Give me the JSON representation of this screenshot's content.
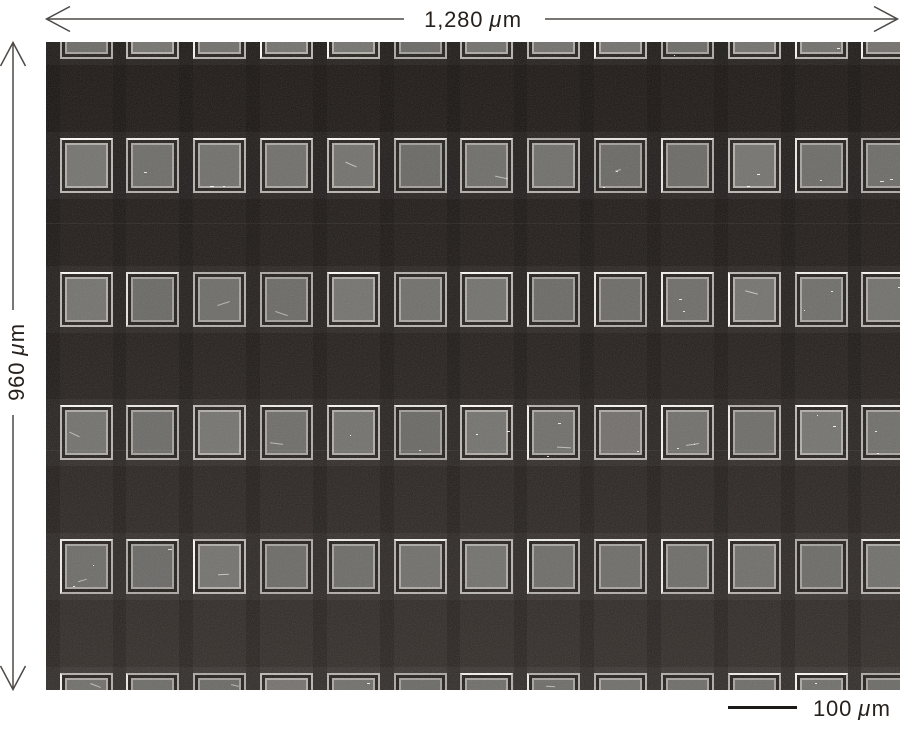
{
  "annotations": {
    "top": {
      "value": "1,280"
    },
    "left": {
      "value": "960"
    },
    "scalebar": {
      "value": "100"
    },
    "unit_mu": "μ",
    "unit_m": "m"
  },
  "annotation_style": {
    "line_color": "#4d4946",
    "text_color": "#27211d",
    "scalebar_color": "#1c1a18"
  },
  "micrograph": {
    "grid": {
      "cols": 13,
      "rows": 6,
      "origin_x": 13.5,
      "origin_y": -38,
      "pitch_x": 66.83,
      "pitch_y": 133.8,
      "square_w": 53,
      "square_h": 55,
      "gap_stripe_w": 13.8
    },
    "colors": {
      "bg_top": "#1a1512",
      "bg_mid": "#221d1a",
      "bg_bottom": "#332d29",
      "fill": "#6e6c68",
      "ring_outer": "#b2afab",
      "ring_inner": "#a9a6a2",
      "ring_gap": "#241f1b",
      "ring_highlight": "#f2f0ec",
      "row_band": "rgba(255,255,255,0.045)",
      "col_stripe": "rgba(0,0,0,0.18)"
    },
    "effects": {
      "scanlines": [
        181,
        408
      ],
      "noise_opacity": 0.2
    }
  }
}
